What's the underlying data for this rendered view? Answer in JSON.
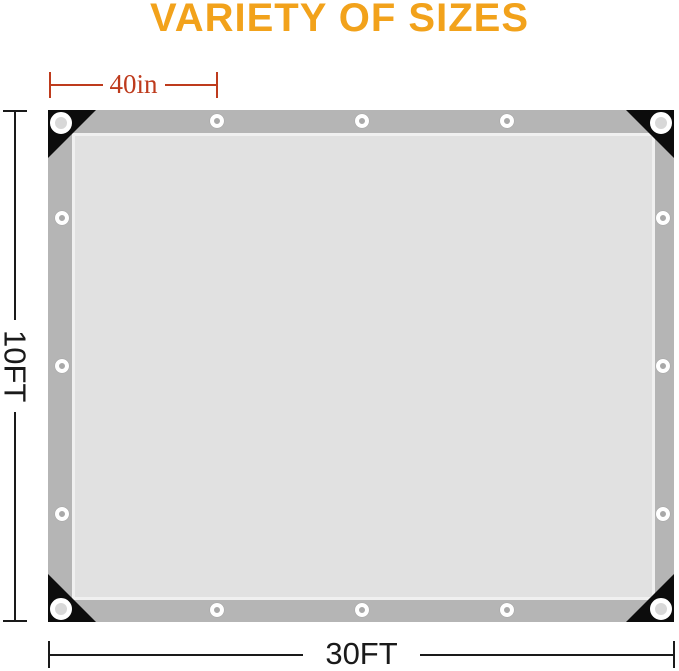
{
  "title": {
    "text": "VARIETY OF SIZES",
    "color": "#F2A21B"
  },
  "product": {
    "name": "tarp-size-diagram",
    "colors": {
      "hem_border": "#B5B5B5",
      "surface": "#E1E1E1",
      "corner_patch": "#0C0C0C",
      "grommet_ring": "#FFFFFF"
    },
    "grommets": {
      "corner_count": 4,
      "edge_count": 12
    }
  },
  "dimensions": {
    "grommet_spacing": {
      "label": "40in",
      "color": "#BE3B1D"
    },
    "height": {
      "label": "10FT",
      "color": "#1A1A1A"
    },
    "width": {
      "label": "30FT",
      "color": "#1A1A1A"
    }
  }
}
